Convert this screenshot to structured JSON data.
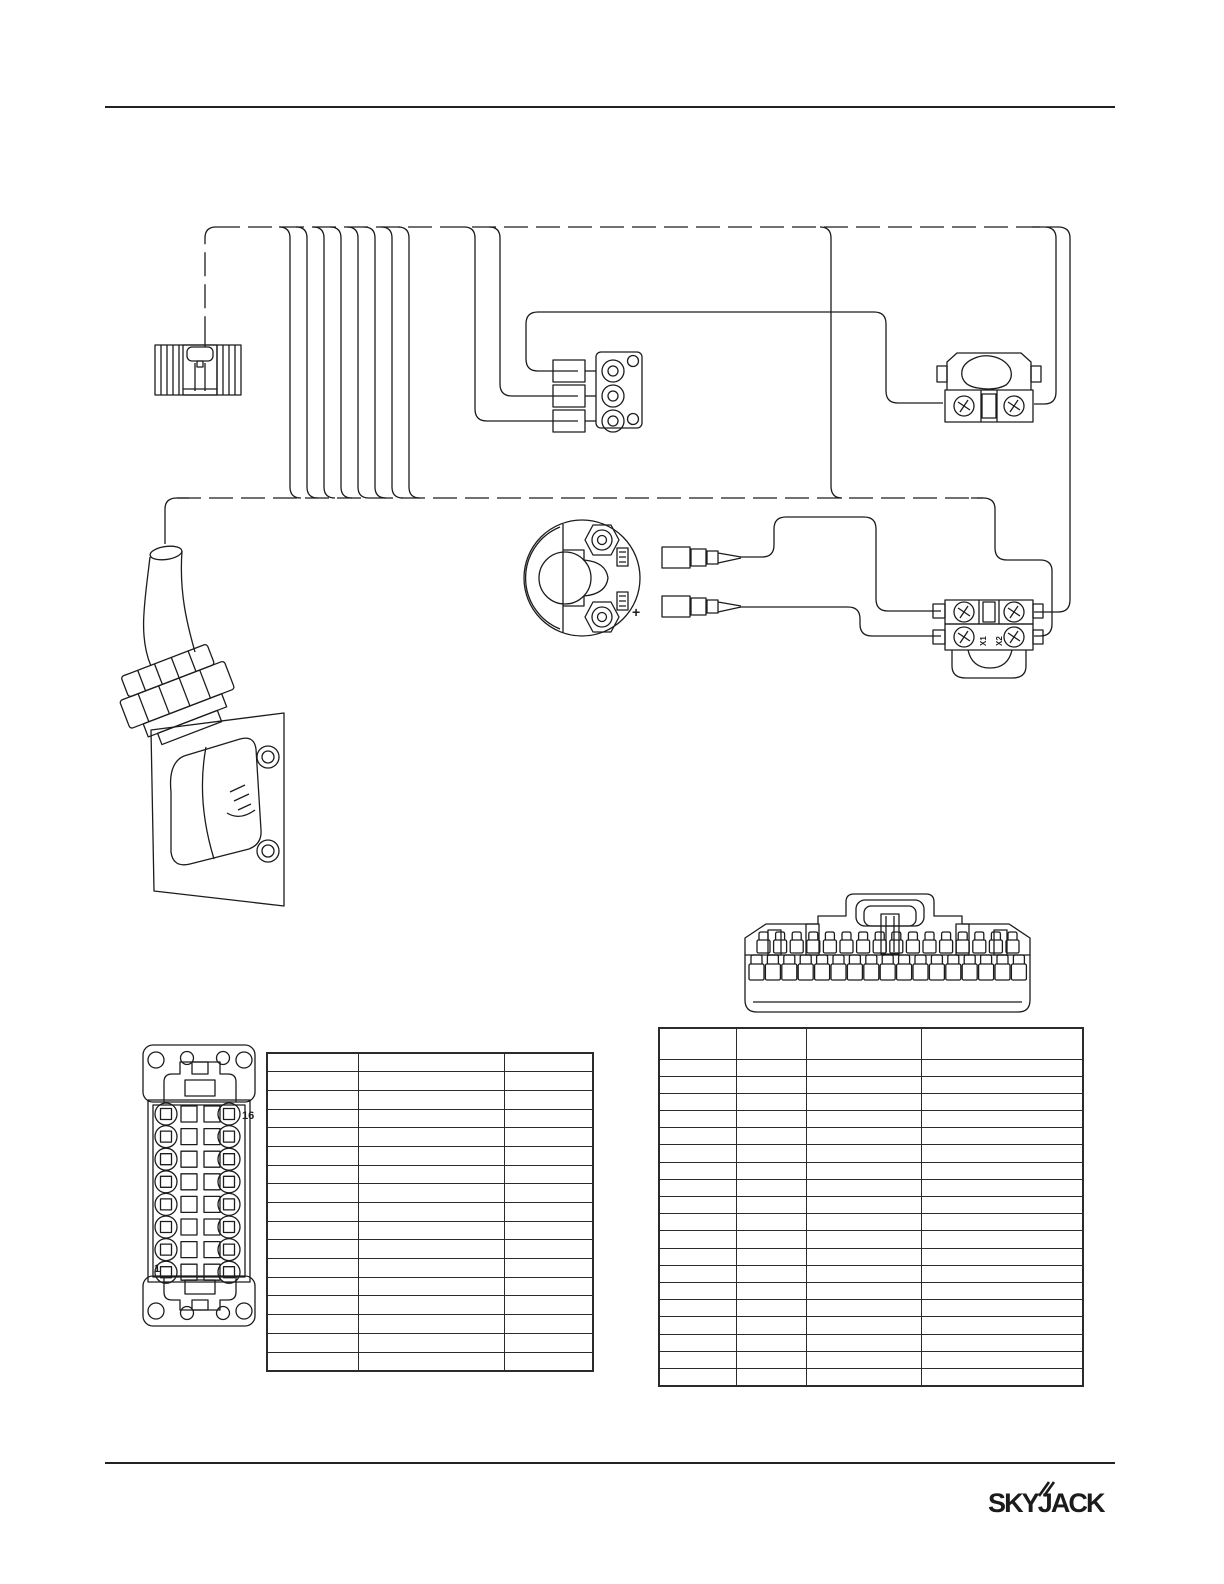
{
  "page": {
    "ink_color": "#1c1c1c"
  },
  "diagram": {
    "horn_polarity_label": "+",
    "pin_label_top": "16",
    "pin_label_bottom": "1",
    "lower_switch_terminal_labels": [
      "X1",
      "X2"
    ]
  },
  "tables": {
    "left": {
      "columns": 3,
      "rows": 17
    },
    "right": {
      "columns": 4,
      "rows": 20
    }
  },
  "footer": {
    "logo_text": "SKYJACK"
  }
}
